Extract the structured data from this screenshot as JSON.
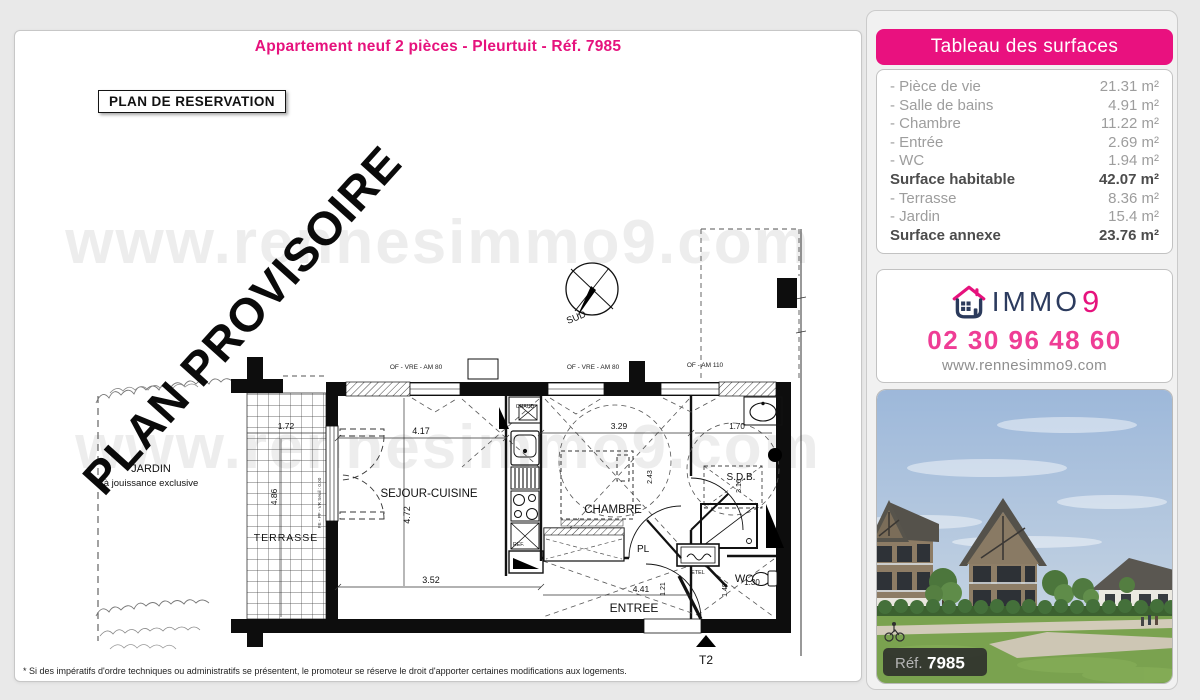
{
  "page": {
    "title": "Appartement neuf 2 pièces - Pleurtuit - Réf. 7985",
    "plan_label": "PLAN DE RESERVATION",
    "provisional_watermark": "PLAN PROVISOIRE",
    "site_watermark": "www.rennesimmo9.com",
    "footnote": "* Si des impératifs d'ordre techniques ou administratifs se présentent, le promoteur se réserve le droit d'apporter certaines modifications aux logements."
  },
  "surfaces": {
    "header": "Tableau des surfaces",
    "rows": [
      {
        "label": "- Pièce de vie",
        "value": "21.31 m²"
      },
      {
        "label": "- Salle de bains",
        "value": "4.91 m²"
      },
      {
        "label": "- Chambre",
        "value": "11.22 m²"
      },
      {
        "label": "- Entrée",
        "value": "2.69 m²"
      },
      {
        "label": "- WC",
        "value": "1.94 m²"
      },
      {
        "label": "Surface habitable",
        "value": "42.07 m²"
      },
      {
        "label": "- Terrasse",
        "value": "8.36 m²"
      },
      {
        "label": "- Jardin",
        "value": "15.4 m²"
      },
      {
        "label": "Surface annexe",
        "value": "23.76 m²"
      }
    ]
  },
  "agency": {
    "brand_name": "IMMO",
    "brand_digit": "9",
    "phone": "02 30 96 48 60",
    "website": "www.rennesimmo9.com"
  },
  "photo": {
    "ref_label": "Réf.",
    "ref_number": "7985"
  },
  "plan": {
    "rooms": {
      "sejour": "SEJOUR-CUISINE",
      "chambre": "CHAMBRE",
      "sdb": "S.D.B.",
      "wc": "WC",
      "entree": "ENTREE",
      "terrasse": "TERRASSE",
      "jardin": "JARDIN",
      "jardin_note": "à jouissance exclusive",
      "pl": "PL"
    },
    "equip": {
      "chaud": "CHAUD",
      "ref": "REF.",
      "etel": "ETEL"
    },
    "openings": {
      "of_am80_a": "OF - VRE - AM 80",
      "of_am80_b": "OF - VRE - AM 80",
      "of_am110": "OF - AM 110",
      "seuil": "FE - PF - VR  Seuil : 0.00"
    },
    "compass": {
      "label": "SUD"
    },
    "type_marker": "T2",
    "dims": {
      "sejour_w": "4.17",
      "sejour_h": "4.72",
      "sejour_bottom": "3.52",
      "chambre_w": "3.29",
      "chambre_h": "2.43",
      "sdb_w": "1.70",
      "sdb_h": "3.16",
      "terrasse_w": "1.72",
      "terrasse_h": "4.86",
      "entree_w": "4.41",
      "entree_h": "1.21",
      "wc_w": "1.30",
      "wc_h": "1.49"
    }
  }
}
